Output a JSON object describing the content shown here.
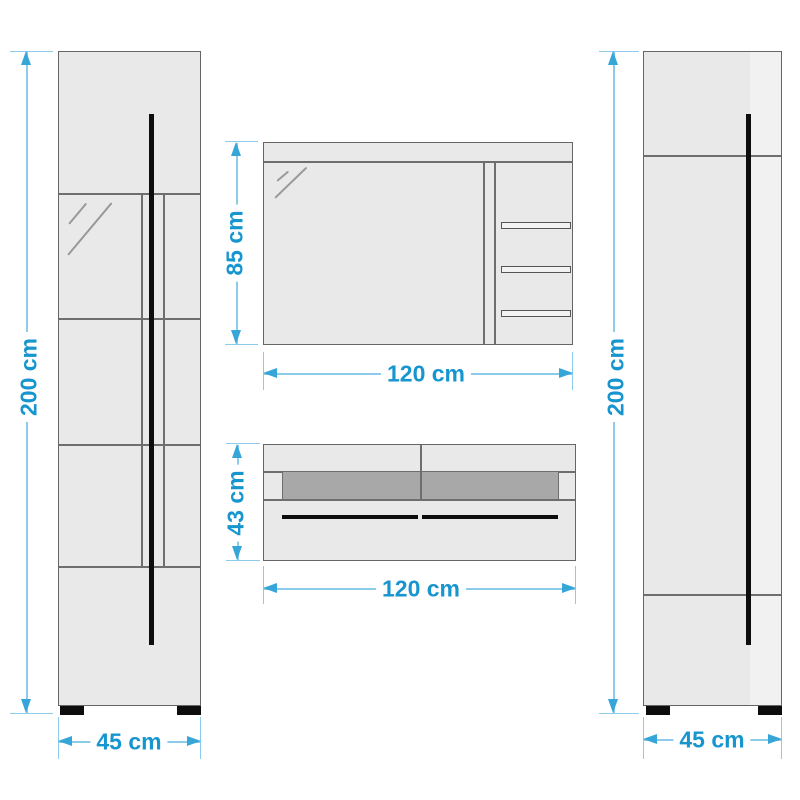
{
  "colors": {
    "accent_text": "#1795cf",
    "dim_line": "#8ccbe9",
    "arrow": "#36a5d8",
    "cabinet_fill": "#e9e9e9",
    "cabinet_fill_light": "#f1f1f1",
    "cabinet_border": "#666666",
    "division_line": "#6e6e6e",
    "dark_band": "#a8a8a8",
    "handle_black": "#0d0d0d",
    "reflection": "#999999"
  },
  "dimensions": {
    "left_cabinet": {
      "height": "200 cm",
      "width": "45 cm"
    },
    "top_cabinet": {
      "height": "85 cm",
      "width": "120 cm"
    },
    "wall_shelf": {
      "height": "43 cm",
      "width": "120 cm"
    },
    "right_cabinet": {
      "height": "200 cm",
      "width": "45 cm"
    }
  }
}
